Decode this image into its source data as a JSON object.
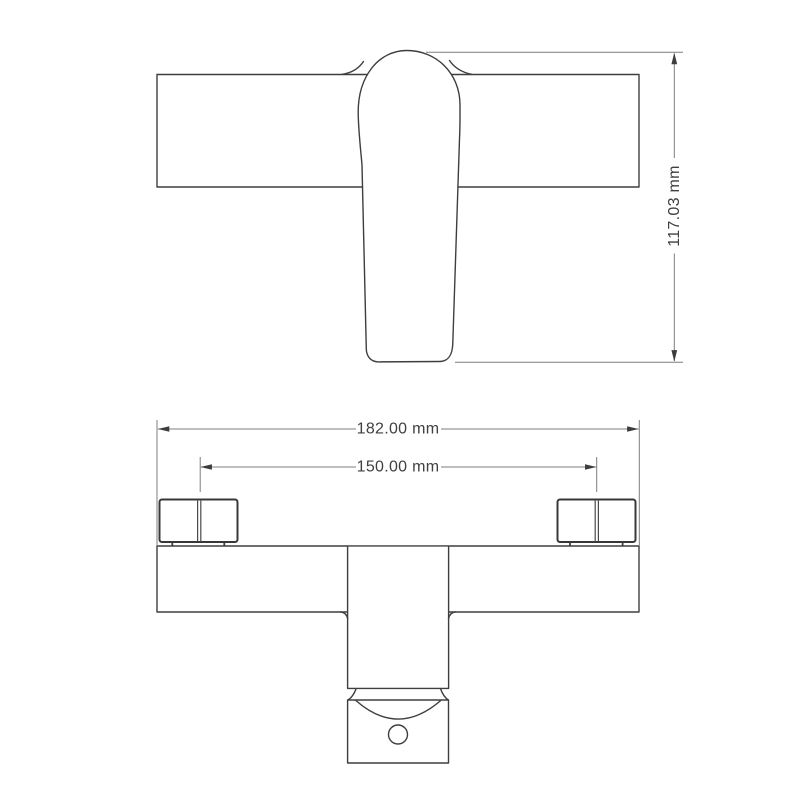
{
  "drawing": {
    "type": "technical-dimension-drawing",
    "subject": "bath shower mixer tap, front elevation (lever view) and plan view",
    "background": "#ffffff",
    "colors": {
      "geometry_line": "#3e3e3e",
      "dimension_line": "#7d7d7d",
      "dimension_text": "#404040"
    },
    "dimensions": {
      "height": {
        "label": "117.03 mm",
        "value_mm": 117.03,
        "orientation": "vertical",
        "applies_to": "overall height of body with lever handle"
      },
      "overall_width": {
        "label": "182.00 mm",
        "value_mm": 182.0,
        "orientation": "horizontal",
        "applies_to": "overall body width"
      },
      "inlet_centers": {
        "label": "150.00 mm",
        "value_mm": 150.0,
        "orientation": "horizontal",
        "applies_to": "distance between inlet connector centres"
      }
    }
  }
}
